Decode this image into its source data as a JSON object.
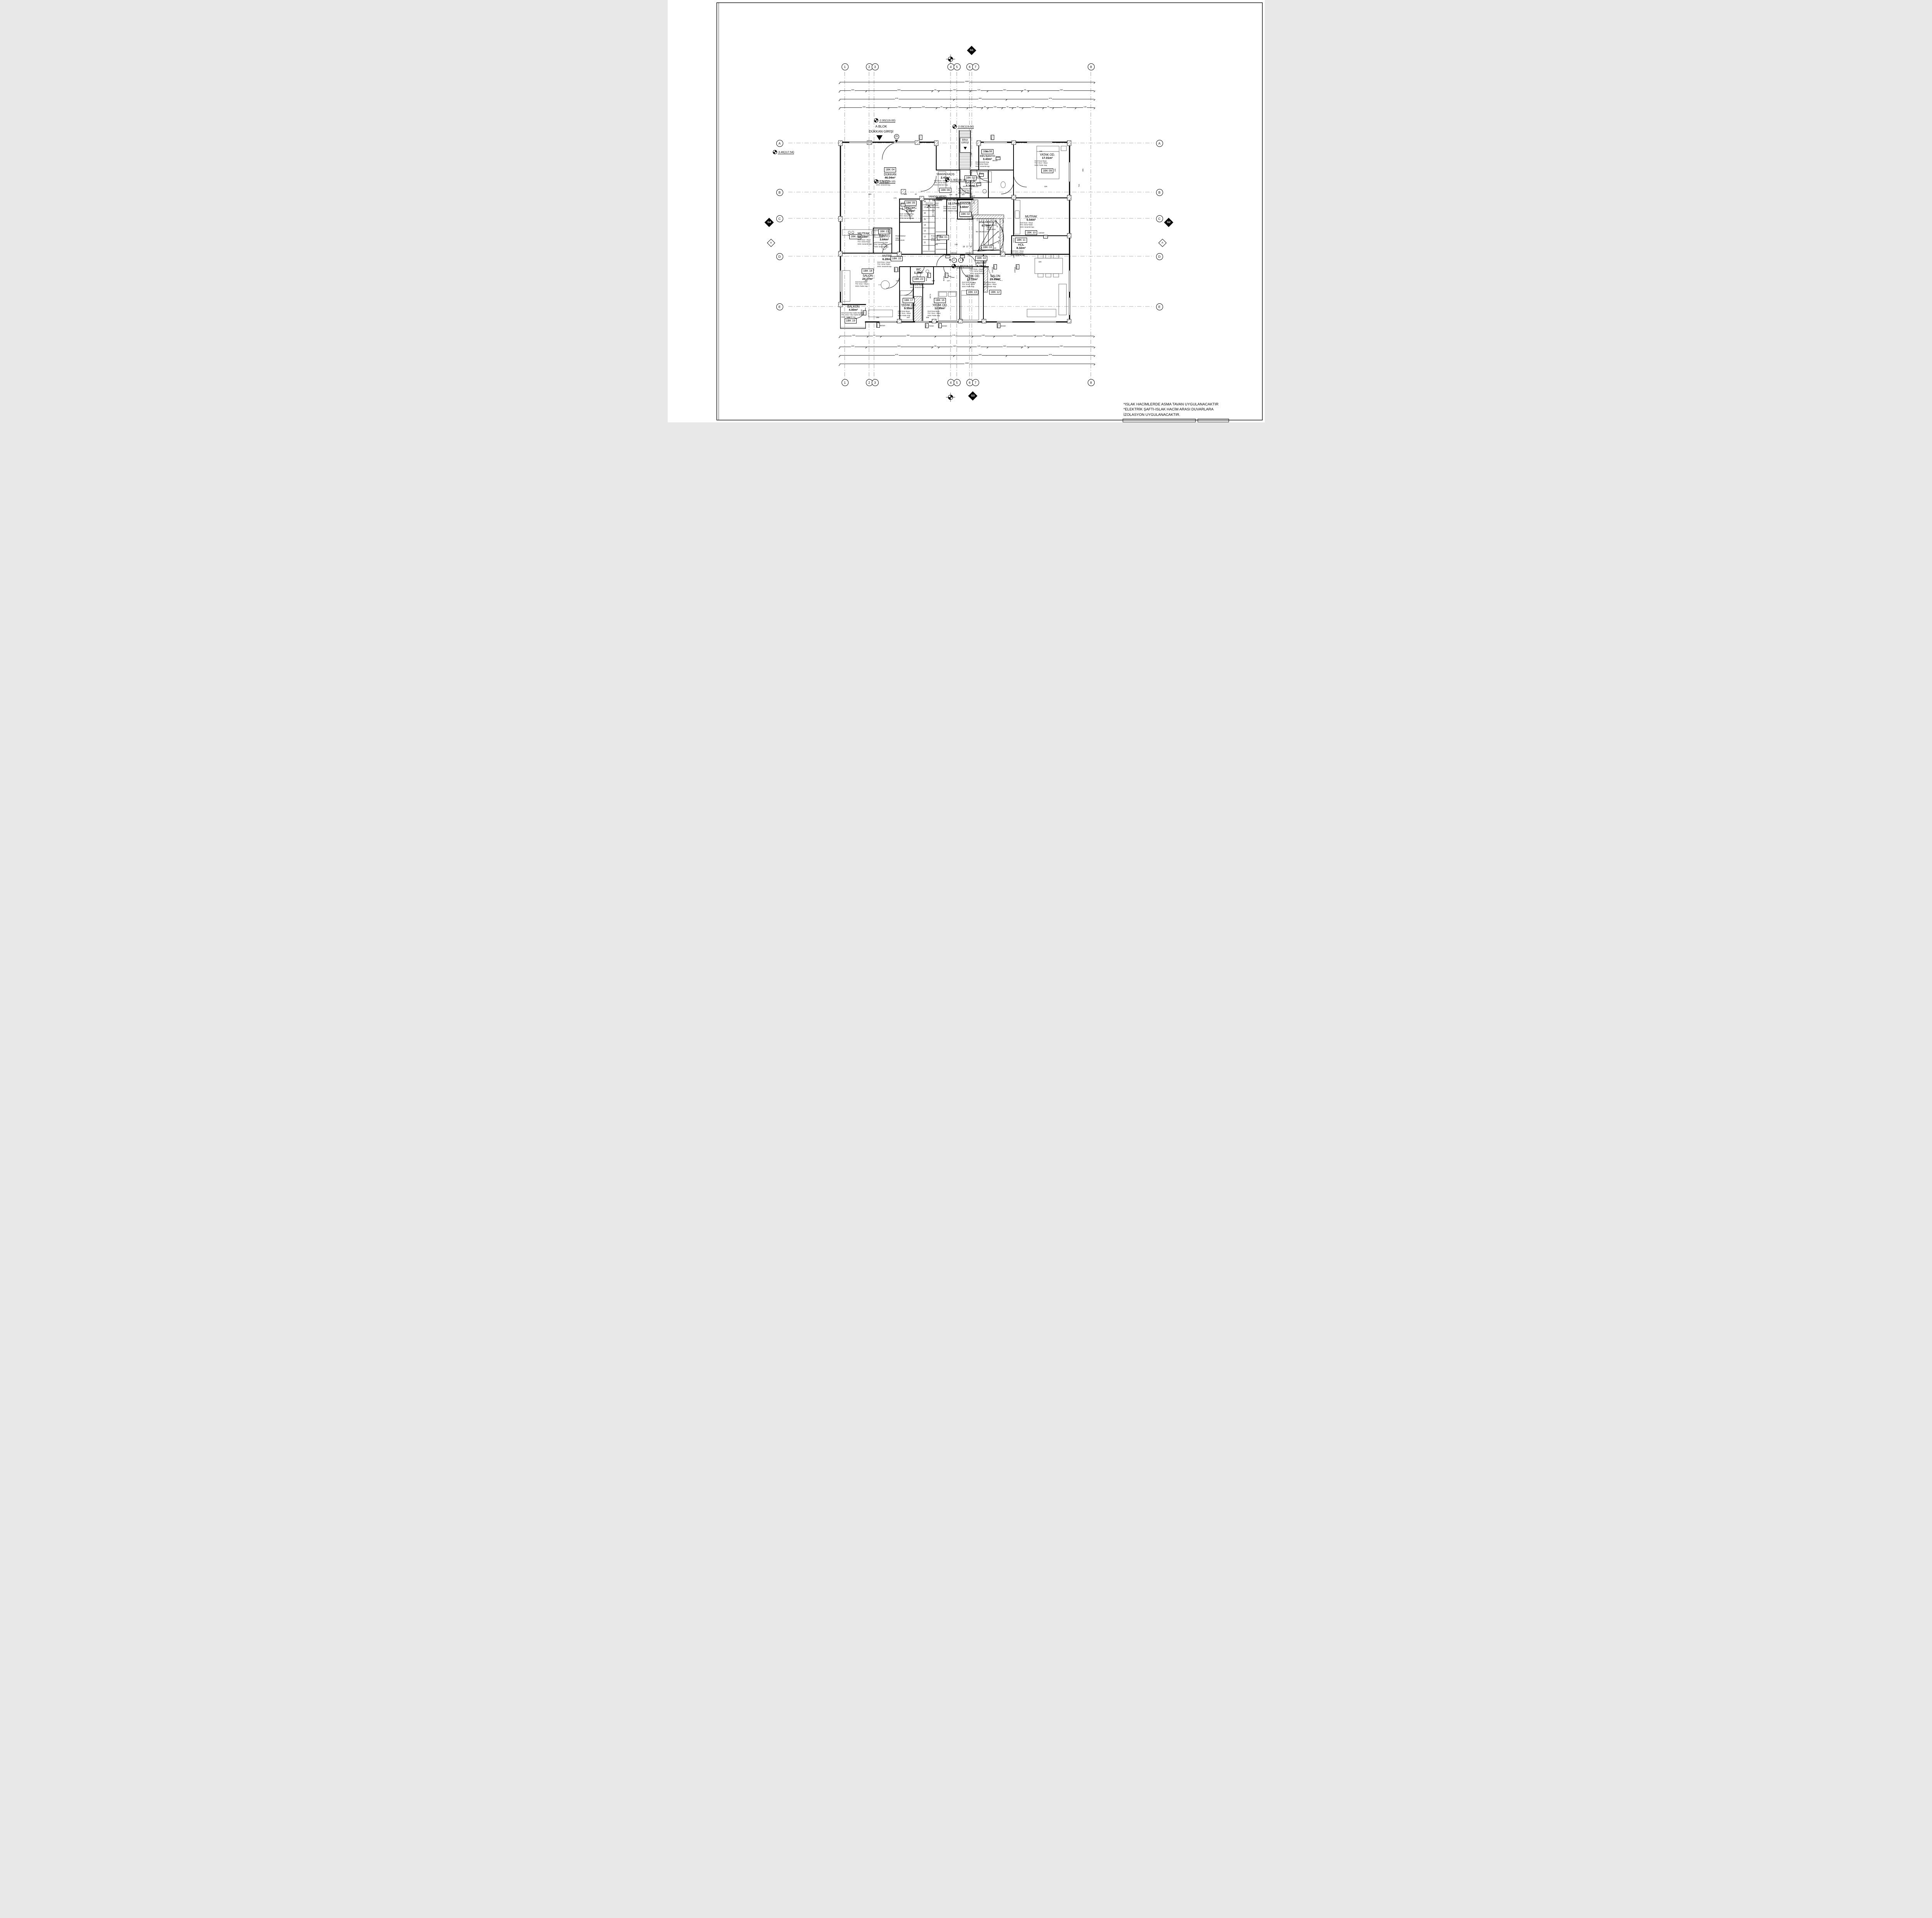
{
  "sheet": {
    "notes": [
      "*ISLAK HACİMLERDE ASMA TAVAN UYGULANACAKTIR",
      "*ELEKTRİK ŞAFTI-ISLAK HACİM ARASI DUVARLARA",
      "İZOLASYON UYGULANACAKTIR."
    ]
  },
  "grid": {
    "cols": [
      "1",
      "2",
      "3",
      "4",
      "5",
      "6",
      "7",
      "8"
    ],
    "rows": [
      "A",
      "B",
      "C",
      "D",
      "E"
    ],
    "axisA": "A",
    "g1": "G1",
    "g2": "G2",
    "g3": "G3",
    "g4": "G4"
  },
  "levels": {
    "l1": "-2.00(119.00)",
    "l2": "-2.00(119.00)",
    "l3": "-1.90(119.10)",
    "l4": "-1.90(119.10)",
    "l5": "-1.90(119.10)",
    "l6": "-3.46(117.54)"
  },
  "entrance": {
    "blok": "A BLOK",
    "dukkan": "DÜKKAN GİRİŞİ",
    "bina1": "BİNA",
    "bina2": "GİRİŞİ",
    "no_shop": "25",
    "no1": "1",
    "no2": "2"
  },
  "rooms": [
    {
      "tag": "1BK 01",
      "name": "",
      "area": "",
      "l1": "",
      "l2": "",
      "l3": ""
    },
    {
      "tag": "1BK 02",
      "name": "",
      "area": "",
      "l1": "",
      "l2": "",
      "l3": ""
    },
    {
      "tag": "1BK 03",
      "name": "",
      "area": "",
      "l1": "",
      "l2": "",
      "l3": ""
    },
    {
      "tag": "1BK 04",
      "name": "DÜKKAN",
      "area": "46.04m²",
      "l1": "DUV:Sıva + Boya",
      "l2": "TAV: Asma Tavan",
      "l3": "DOS: Seramik Kap."
    },
    {
      "tag": "1BK 05",
      "name": "ENG.WC",
      "area": "2.95m²",
      "l1": "DUV: Seramik Kap.",
      "l2": "TAV: Asma Tavan",
      "l3": "DOS: Seramik Kap."
    },
    {
      "tag": "1BK 06",
      "name": "YANGIN KAÇIŞ",
      "area": "2.43m²",
      "l1": "DUV:Sıva + Boya",
      "l2": "TAV: Asma Tavan",
      "l3": "DOS: Mermer Kap."
    },
    {
      "tag": "1BK 07",
      "name": "BANYO",
      "area": "5.36m²",
      "l1": "DUV:Seramik Kap.",
      "l2": "TAV: Asma Tavan",
      "l3": "DOS: Seramik Kap."
    },
    {
      "tag": "1BK 08",
      "name": "EBV.BANYO",
      "area": "3.43m²",
      "l1": "DUV:Seramik Kap.",
      "l2": "TAV: Asma Tavan",
      "l3": "DOS: Seramik Kap."
    },
    {
      "tag": "1BK 09",
      "name": "YATAK OD.",
      "area": "17.01m²",
      "l1": "DUV:Sıva+Boya",
      "l2": "TAV: Sıva + Boya",
      "l3": "DOS: Parke Kap."
    },
    {
      "tag": "1BK 10",
      "name": "MUTFAK",
      "area": "5.54m²",
      "l1": "DUV:Sıva + Boya",
      "l2": "TAV: Asma Tavan",
      "l3": "DOS: Seramik Kap."
    },
    {
      "tag": "1BK 11",
      "name": "HOL",
      "area": "8.32m²",
      "l1": "DUV:Sıva + Boya",
      "l2": "TAV: Asma Tavan",
      "l3": "DOS: Seramik Kap."
    },
    {
      "tag": "1BK 12",
      "name": "SALON",
      "area": "29.65m²",
      "l1": "DUV:Sıva+Boya",
      "l2": "TAV: Sıva + Boya",
      "l3": "DOS: Parke Kap."
    },
    {
      "tag": "1BK 13",
      "name": "YATAK OD.",
      "area": "13.12m²",
      "l1": "DUV:Sıva+Boya",
      "l2": "TAV: Sıva + Boya",
      "l3": "DOS: Parke Kap."
    },
    {
      "tag": "1BK 14",
      "name": "ANTRE",
      "area": "5.78m²",
      "l1": "DUV:Sıva + Boya",
      "l2": "TAV: Asma Tavan",
      "l3": "DOS: Seramik Kap."
    },
    {
      "tag": "1BK 15",
      "name": "ANTRE",
      "area": "6.28m²",
      "l1": "DUV:Sıva + Boya",
      "l2": "TAV: Asma Tavan",
      "l3": "DOS: Seramik Kap."
    },
    {
      "tag": "1BK 16",
      "name": "YATAK OD.",
      "area": "12.95m²",
      "l1": "DUV:Sıva+Boya",
      "l2": "TAV: Sıva + Boya",
      "l3": "DOS: Parke Kap."
    },
    {
      "tag": "1BK 17",
      "name": "YATAK OD.",
      "area": "9.55m²",
      "l1": "DUV:Sıva+Boya",
      "l2": "TAV: Sıva + Boya",
      "l3": "DOS: Parke Kap."
    },
    {
      "tag": "1BK 18",
      "name": "SALON",
      "area": "24.27m²",
      "l1": "DUV:Sıva+Boya",
      "l2": "TAV: Sıva + Boya",
      "l3": "DOS: Parke Kap."
    },
    {
      "tag": "1BK 19",
      "name": "BALKON",
      "area": "4.00m²",
      "l1": "DUV:Sıva+Dış Cephe Boyası",
      "l2": "TAV: Sıva + Dış Cephe Boyası",
      "l3": "DOS: Seramik Kap."
    },
    {
      "tag": "1BK 20",
      "name": "MUTFAK",
      "area": "12.10m²",
      "l1": "DUV:Sıva + Boya",
      "l2": "TAV: Asma Tavan",
      "l3": "DOS: Seramik Kap."
    },
    {
      "tag": "1BK 21",
      "name": "BANYO",
      "area": "3.64m²",
      "l1": "DUV:Seramik Kap.",
      "l2": "TAV: Asma Tavan",
      "l3": "DOS: Seramik Kap."
    },
    {
      "tag": "1BK 22",
      "name": "WC",
      "area": "1.20m²",
      "l1": "DUV:Seramik Kap.",
      "l2": "TAV: Asma Tavan",
      "l3": "DOS: Seramik Kap."
    }
  ],
  "common": [
    {
      "name": "YANGIN MERD.",
      "area": "12.09m²",
      "l1": "DUV:Sıva + Boya",
      "l2": "TAV: Asma Tavan",
      "l3": "DOS: Mermer Kap."
    },
    {
      "name": "KAT HOLÜ",
      "area": "12.17m²",
      "l1": "DUV:Sıva + Boya",
      "l2": "TAV: Asma Tavan",
      "l3": "DOS: Mermer Kap."
    },
    {
      "name": "ASANSÖR",
      "area": "3.60m²"
    },
    {
      "name": "ANA MERD.",
      "area": "6.79m²"
    }
  ],
  "stair": {
    "m1": "M1 18x16.1/25",
    "m2": "M2 18x16.11/27",
    "shaft": "ŞAFT",
    "railing": [
      "PASLANMAZ",
      "ÇELİK",
      "KORKULUK"
    ],
    "fire_treads": [
      "18",
      "17",
      "16",
      "15",
      "14",
      "13",
      "12",
      "11"
    ],
    "main_treads": [
      "1",
      "2",
      "3",
      "4",
      "5",
      "6",
      "7",
      "8",
      "9",
      "10"
    ]
  },
  "tags": {
    "k01": "K01",
    "k01s": "100/210",
    "k02": "K02",
    "k02s": "90/210",
    "k03": "K03",
    "k03s": "80/210",
    "k04": "K04",
    "k04s": "120/210",
    "p01": "P01",
    "p01s": "250/220",
    "p02": "P02",
    "p02s": "170/220",
    "p03": "P03",
    "p03s": "190/220",
    "p04": "P04",
    "p04s": "120/220",
    "p12": "P12",
    "p13": "P13",
    "p13s": "140/150"
  },
  "dims": {
    "top_total": [
      "1950"
    ],
    "top2": [
      "200",
      "500",
      "50",
      "240",
      "130",
      "260",
      "50",
      "500"
    ],
    "top3": [
      "875",
      "400",
      "675"
    ],
    "top4": [
      "340",
      "150",
      "180",
      "70",
      "145",
      "100",
      "40",
      "100",
      "70",
      "70",
      "140",
      "70",
      "155",
      "130"
    ],
    "bot1": [
      "130",
      "60",
      "250",
      "170",
      "100",
      "190",
      "80",
      "190"
    ],
    "bot2": [
      "200",
      "500",
      "50",
      "240",
      "130",
      "260",
      "50",
      "500"
    ],
    "bot3": [
      "875",
      "400",
      "675"
    ],
    "bot_total": [
      "1950"
    ],
    "sc": [
      "685",
      "120",
      "20",
      "170",
      "400",
      "200",
      "190",
      "445",
      "435",
      "465",
      "715",
      "325",
      "325",
      "110",
      "187.5",
      "162.5",
      "203",
      "195",
      "120",
      "180",
      "200",
      "45",
      "25",
      "130",
      "172.5",
      "130",
      "325",
      "457.5",
      "168",
      "137",
      "485",
      "130",
      "445",
      "235",
      "70",
      "210",
      "240",
      "305",
      "200",
      "285",
      "260",
      "130",
      "160"
    ]
  }
}
